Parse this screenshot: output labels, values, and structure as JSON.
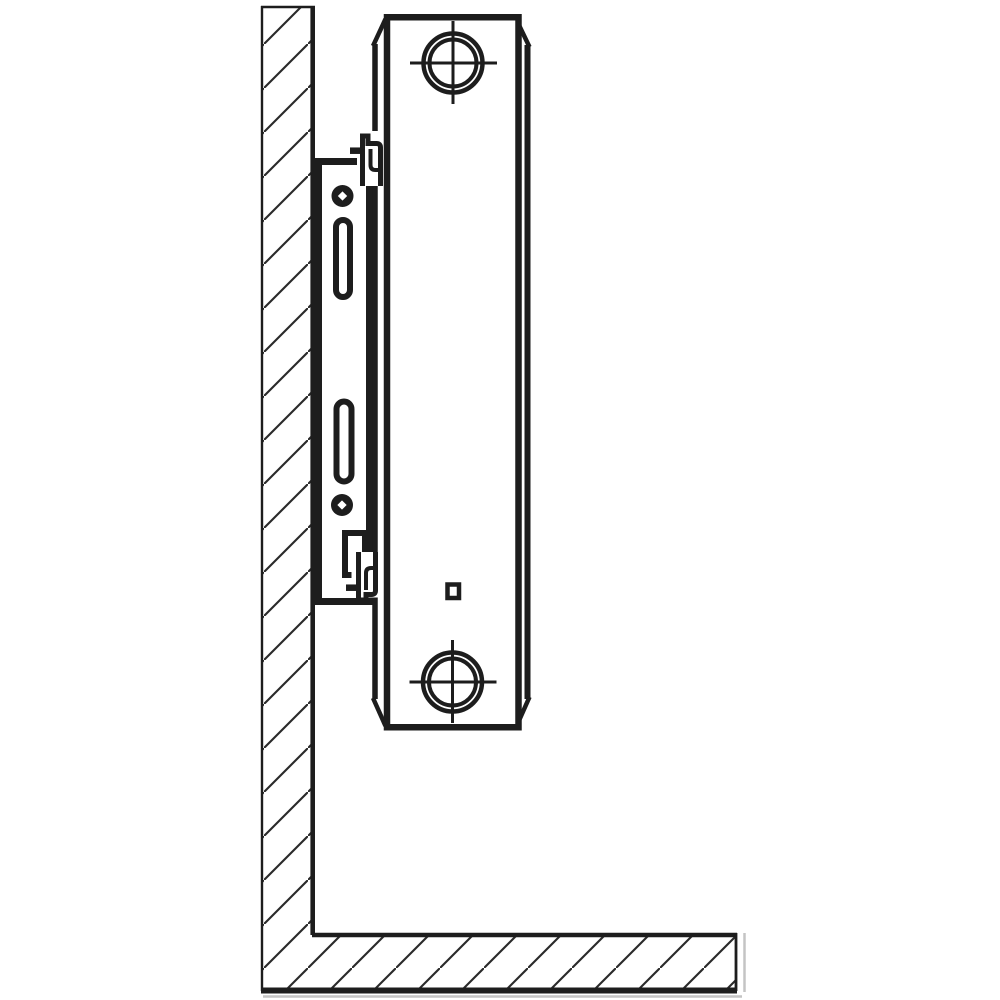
{
  "meta": {
    "kind": "technical-line-drawing",
    "description": "Side-view installation diagram of a panel radiator hung on a wall mounting bracket above the floor"
  },
  "colors": {
    "background": "#ffffff",
    "line": "#1d1d1d",
    "hatch": "#2a2a2a",
    "shadow": "#c4c4c4"
  },
  "parts": {
    "diagram": "radiator wall-mounting side view",
    "wall": "wall cross-section (hatched)",
    "floor": "floor cross-section (hatched)",
    "bracket": "wall mounting bracket plate",
    "bracket_hole_top": "bracket fixing hole (top)",
    "bracket_slot_top": "bracket adjustment slot (top)",
    "bracket_slot_bottom": "bracket adjustment slot (bottom)",
    "bracket_hole_bottom": "bracket fixing hole (bottom)",
    "bracket_hook_top": "bracket retaining hook (top)",
    "bracket_notch_bottom": "bracket cut-out (bottom)",
    "bracket_hook_bottom": "bracket retaining clip (bottom)",
    "radiator_panel": "radiator side panel",
    "radiator_profile": "radiator depth profile lines",
    "connection_top": "top pipe connection axis mark",
    "connection_bottom": "bottom pipe connection axis mark",
    "panel_detail_square": "small square detail on panel"
  }
}
